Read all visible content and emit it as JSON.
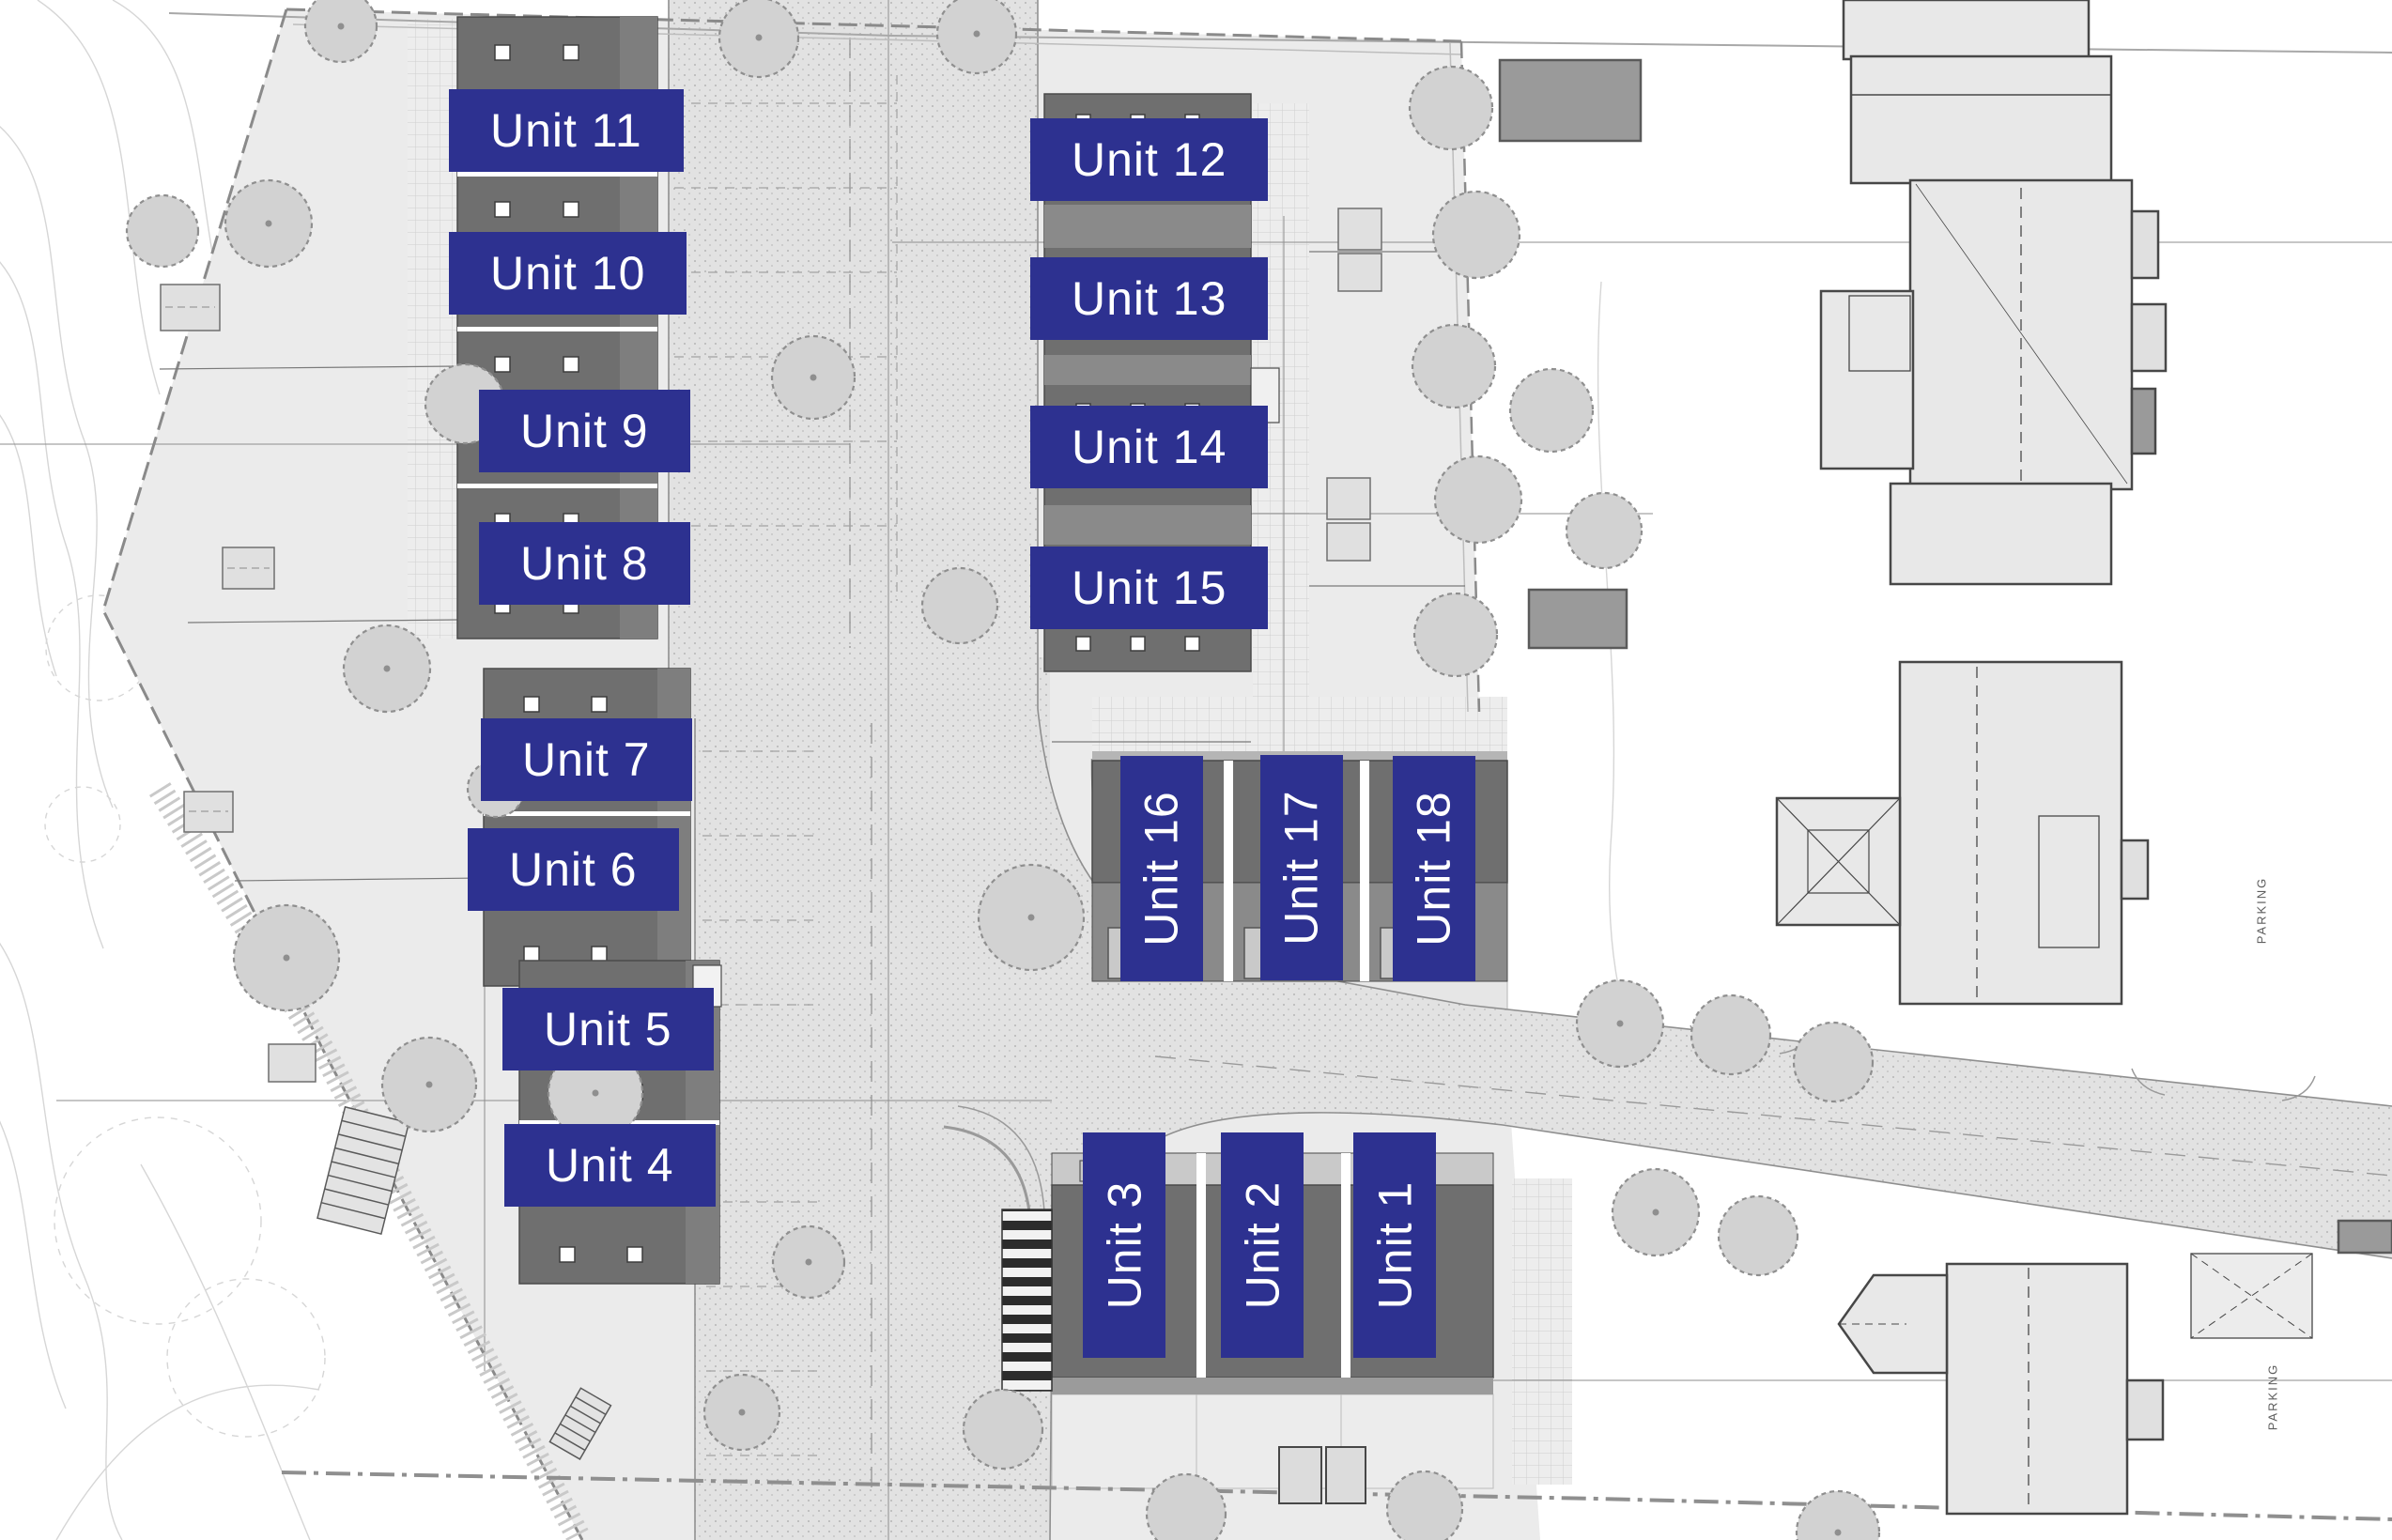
{
  "plan_title": "Development site plan",
  "units": [
    {
      "label": "Unit 1",
      "orientation": "vertical"
    },
    {
      "label": "Unit 2",
      "orientation": "vertical"
    },
    {
      "label": "Unit 3",
      "orientation": "vertical"
    },
    {
      "label": "Unit 4",
      "orientation": "horizontal"
    },
    {
      "label": "Unit 5",
      "orientation": "horizontal"
    },
    {
      "label": "Unit 6",
      "orientation": "horizontal"
    },
    {
      "label": "Unit 7",
      "orientation": "horizontal"
    },
    {
      "label": "Unit 8",
      "orientation": "horizontal"
    },
    {
      "label": "Unit 9",
      "orientation": "horizontal"
    },
    {
      "label": "Unit 10",
      "orientation": "horizontal"
    },
    {
      "label": "Unit 11",
      "orientation": "horizontal"
    },
    {
      "label": "Unit 12",
      "orientation": "horizontal"
    },
    {
      "label": "Unit 13",
      "orientation": "horizontal"
    },
    {
      "label": "Unit 14",
      "orientation": "horizontal"
    },
    {
      "label": "Unit 15",
      "orientation": "horizontal"
    },
    {
      "label": "Unit 16",
      "orientation": "vertical"
    },
    {
      "label": "Unit 17",
      "orientation": "vertical"
    },
    {
      "label": "Unit 18",
      "orientation": "vertical"
    }
  ],
  "annotations": {
    "parking_labels": [
      "PARKING",
      "PARKING"
    ]
  },
  "colors": {
    "label_bg": "#2d3190",
    "label_text": "#ffffff",
    "roof_dark": "#6f6f6f",
    "paving": "#e3e3e3",
    "building_fill": "#e8e8e8"
  }
}
